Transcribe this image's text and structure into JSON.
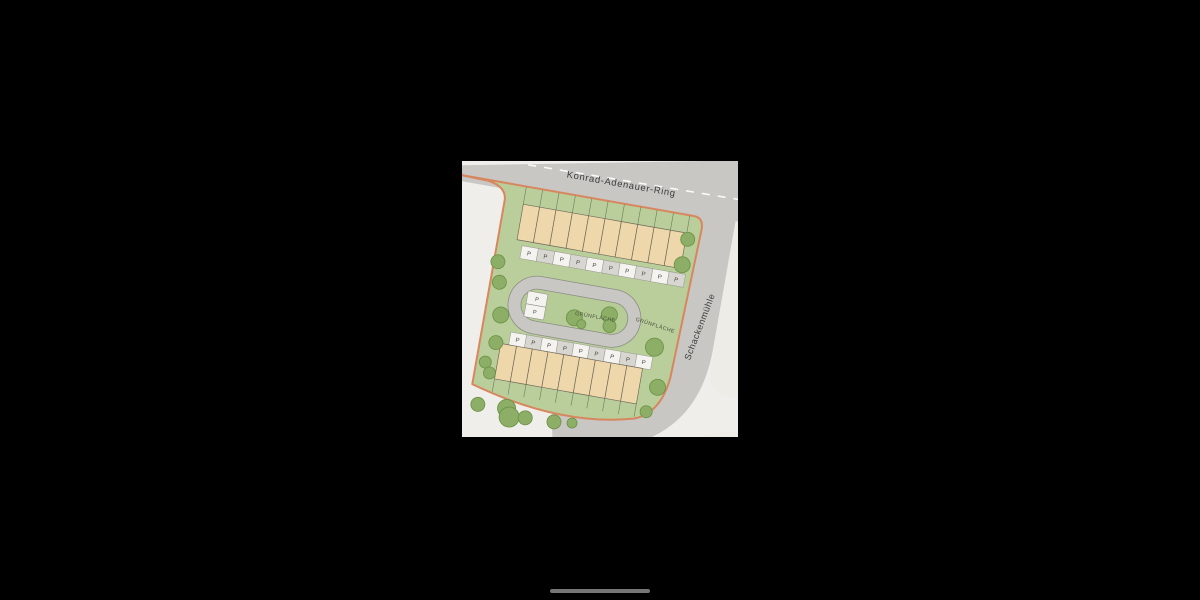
{
  "plan": {
    "roads": {
      "top_road_label": "Konrad-Adenauer-Ring",
      "right_road_label": "Schackenmühle"
    },
    "green_areas": {
      "island_label": "GRÜNFLÄCHE",
      "east_label": "GRÜNFLÄCHE"
    },
    "parking": {
      "letter": "P",
      "north_spaces": 10,
      "south_spaces": 9,
      "island_spaces": 2
    },
    "housing": {
      "north_units": 10,
      "south_units": 9
    },
    "trees": {
      "left_strip": [
        [
          31,
          119,
          7
        ],
        [
          36,
          139,
          7
        ],
        [
          43,
          171,
          8
        ],
        [
          43,
          199,
          7
        ],
        [
          36,
          220,
          6
        ],
        [
          42,
          230,
          6
        ]
      ],
      "east_strip": [
        [
          214,
          64,
          7
        ],
        [
          213,
          90,
          8
        ],
        [
          200,
          176,
          9
        ],
        [
          210,
          215,
          8
        ],
        [
          203,
          241,
          6
        ]
      ],
      "island": [
        [
          116,
          161,
          8
        ],
        [
          150,
          152,
          8
        ],
        [
          152,
          163,
          6.5
        ],
        [
          124,
          166,
          4.5
        ]
      ],
      "outside_south": [
        [
          36,
          263,
          7
        ],
        [
          65,
          262,
          9
        ],
        [
          69,
          270,
          10
        ],
        [
          85,
          268,
          7
        ],
        [
          114,
          267,
          7
        ],
        [
          132,
          265,
          5
        ]
      ]
    },
    "colors": {
      "background": "#f0eeea",
      "road": "#c8c7c4",
      "road_edge": "#8d8d85",
      "parcel": "#edece7",
      "site_green": "#b9ce9a",
      "island_green": "#b6cc96",
      "boundary": "#d8865e",
      "house_fill": "#efd7ac",
      "house_stroke": "#6f6a58",
      "garden_line": "#6f7a5e",
      "parking_light": "#f4f3f0",
      "parking_dark": "#d8d6d1",
      "parking_stroke": "#97968c",
      "parking_text": "#45453f",
      "tree_fill": "#8cae66",
      "tree_stroke": "#6f9449",
      "dash_line": "#fafaf8",
      "home_indicator": "#757575",
      "letterbox": "#000000"
    }
  }
}
